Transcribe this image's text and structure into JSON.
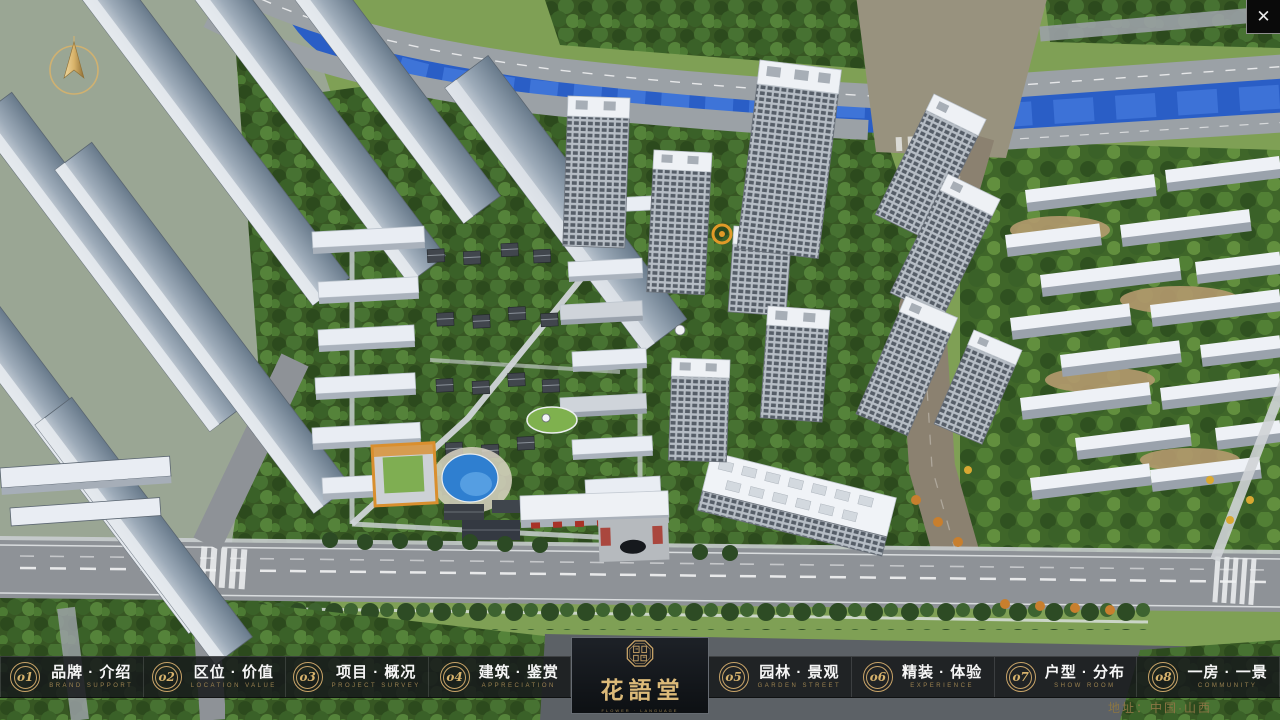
{
  "colors": {
    "gold": "#c9a468",
    "gold_dim": "#9b8250",
    "bar_bg": "rgba(22,24,27,0.86)",
    "river": "#2a5ec6",
    "accent_red": "#a83228"
  },
  "close": {
    "glyph": "✕"
  },
  "nav": {
    "items": [
      {
        "num": "o1",
        "zh": "品牌 · 介绍",
        "en": "BRAND SUPPORT"
      },
      {
        "num": "o2",
        "zh": "区位 · 价值",
        "en": "LOCATION VALUE"
      },
      {
        "num": "o3",
        "zh": "项目 · 概况",
        "en": "PROJECT SURVEY"
      },
      {
        "num": "o4",
        "zh": "建筑 · 鉴赏",
        "en": "APPRECIATION"
      },
      {
        "num": "o5",
        "zh": "园林 · 景观",
        "en": "GARDEN STREET"
      },
      {
        "num": "o6",
        "zh": "精装 · 体验",
        "en": "EXPERIENCE"
      },
      {
        "num": "o7",
        "zh": "户型 · 分布",
        "en": "SHOW ROOM"
      },
      {
        "num": "o8",
        "zh": "一房 · 一景",
        "en": "COMMUNITY"
      }
    ],
    "logo": {
      "name": "花語堂",
      "tagline": "FLOWER · LANGUAGE"
    }
  },
  "footer": {
    "address": "地址：中国·山西"
  }
}
